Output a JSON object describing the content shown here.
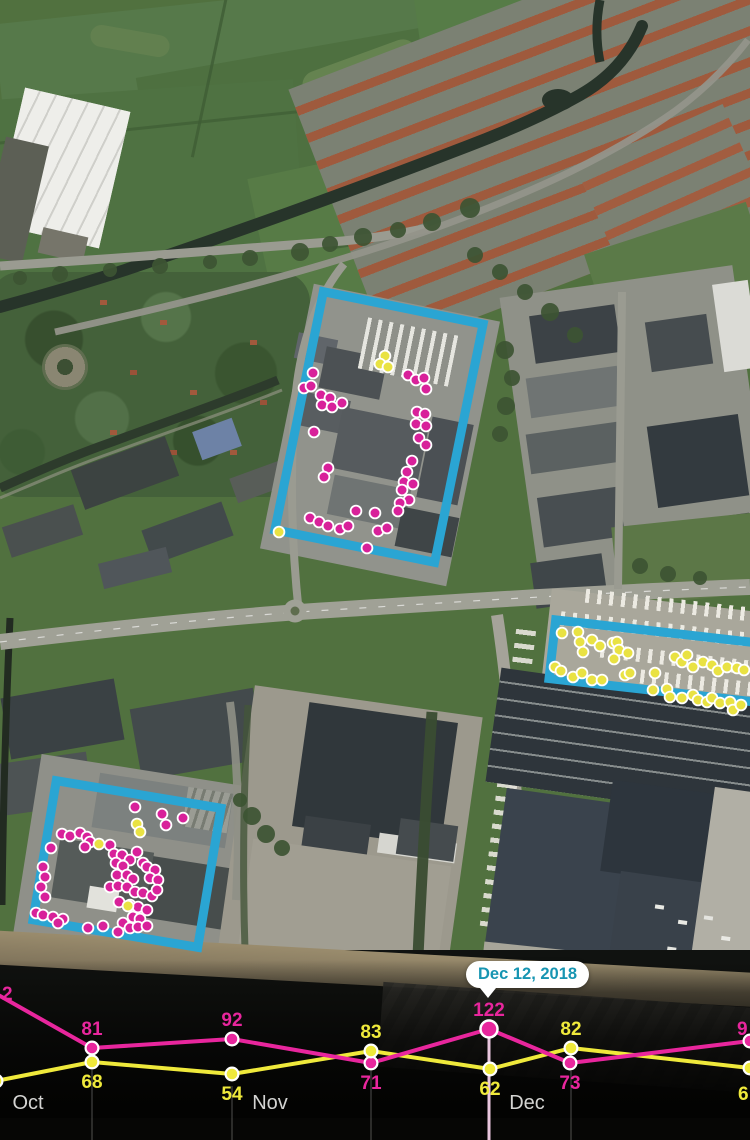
{
  "overlay_colors": {
    "magenta": "#d8219a",
    "yellow": "#e9e243",
    "cyan": "#2aa5d3",
    "tooltip_text": "#1795b2",
    "month_label": "#d4d4d2",
    "gridline": "rgba(255,255,255,0.3)",
    "highlight_gridline": "#e9c6de"
  },
  "map": {
    "regions": [
      {
        "name": "north-site",
        "cx": 379,
        "cy": 427,
        "w": 172,
        "h": 252,
        "angle": 11.5
      },
      {
        "name": "east-site",
        "cx": 682,
        "cy": 664,
        "w": 270,
        "h": 68,
        "angle": 6.5
      },
      {
        "name": "south-site",
        "cx": 127,
        "cy": 864,
        "w": 176,
        "h": 150,
        "angle": 9.5
      }
    ],
    "magenta_dots": [
      [
        313,
        373
      ],
      [
        304,
        388
      ],
      [
        311,
        386
      ],
      [
        321,
        395
      ],
      [
        330,
        398
      ],
      [
        322,
        405
      ],
      [
        332,
        407
      ],
      [
        342,
        403
      ],
      [
        408,
        375
      ],
      [
        416,
        380
      ],
      [
        424,
        378
      ],
      [
        426,
        389
      ],
      [
        417,
        412
      ],
      [
        425,
        414
      ],
      [
        416,
        424
      ],
      [
        426,
        426
      ],
      [
        419,
        438
      ],
      [
        426,
        445
      ],
      [
        412,
        461
      ],
      [
        407,
        472
      ],
      [
        404,
        482
      ],
      [
        413,
        484
      ],
      [
        402,
        490
      ],
      [
        409,
        500
      ],
      [
        400,
        503
      ],
      [
        398,
        511
      ],
      [
        314,
        432
      ],
      [
        328,
        468
      ],
      [
        324,
        477
      ],
      [
        356,
        511
      ],
      [
        375,
        513
      ],
      [
        310,
        518
      ],
      [
        319,
        522
      ],
      [
        328,
        526
      ],
      [
        340,
        529
      ],
      [
        348,
        526
      ],
      [
        378,
        531
      ],
      [
        387,
        528
      ],
      [
        367,
        548
      ],
      [
        135,
        807
      ],
      [
        162,
        814
      ],
      [
        183,
        818
      ],
      [
        166,
        825
      ],
      [
        62,
        834
      ],
      [
        70,
        836
      ],
      [
        80,
        833
      ],
      [
        87,
        837
      ],
      [
        90,
        842
      ],
      [
        85,
        847
      ],
      [
        51,
        848
      ],
      [
        110,
        845
      ],
      [
        114,
        854
      ],
      [
        122,
        855
      ],
      [
        137,
        852
      ],
      [
        130,
        860
      ],
      [
        116,
        863
      ],
      [
        123,
        866
      ],
      [
        43,
        867
      ],
      [
        45,
        877
      ],
      [
        117,
        875
      ],
      [
        127,
        875
      ],
      [
        133,
        879
      ],
      [
        143,
        863
      ],
      [
        147,
        867
      ],
      [
        155,
        870
      ],
      [
        150,
        878
      ],
      [
        158,
        880
      ],
      [
        110,
        887
      ],
      [
        118,
        886
      ],
      [
        127,
        887
      ],
      [
        41,
        887
      ],
      [
        135,
        892
      ],
      [
        143,
        893
      ],
      [
        152,
        896
      ],
      [
        157,
        890
      ],
      [
        45,
        897
      ],
      [
        36,
        913
      ],
      [
        43,
        915
      ],
      [
        53,
        917
      ],
      [
        63,
        919
      ],
      [
        58,
        923
      ],
      [
        119,
        902
      ],
      [
        130,
        905
      ],
      [
        138,
        907
      ],
      [
        147,
        910
      ],
      [
        133,
        917
      ],
      [
        140,
        919
      ],
      [
        123,
        923
      ],
      [
        130,
        928
      ],
      [
        138,
        927
      ],
      [
        118,
        932
      ],
      [
        88,
        928
      ],
      [
        103,
        926
      ],
      [
        147,
        926
      ]
    ],
    "yellow_dots": [
      [
        385,
        356
      ],
      [
        380,
        364
      ],
      [
        388,
        367
      ],
      [
        279,
        532
      ],
      [
        137,
        824
      ],
      [
        140,
        832
      ],
      [
        99,
        844
      ],
      [
        128,
        906
      ],
      [
        562,
        633
      ],
      [
        578,
        632
      ],
      [
        580,
        642
      ],
      [
        592,
        640
      ],
      [
        600,
        646
      ],
      [
        583,
        652
      ],
      [
        613,
        643
      ],
      [
        617,
        642
      ],
      [
        619,
        650
      ],
      [
        614,
        659
      ],
      [
        628,
        653
      ],
      [
        555,
        667
      ],
      [
        561,
        671
      ],
      [
        573,
        677
      ],
      [
        582,
        673
      ],
      [
        592,
        680
      ],
      [
        602,
        680
      ],
      [
        625,
        675
      ],
      [
        630,
        673
      ],
      [
        655,
        673
      ],
      [
        675,
        657
      ],
      [
        682,
        662
      ],
      [
        687,
        655
      ],
      [
        693,
        667
      ],
      [
        703,
        662
      ],
      [
        712,
        665
      ],
      [
        718,
        671
      ],
      [
        727,
        667
      ],
      [
        737,
        668
      ],
      [
        744,
        670
      ],
      [
        653,
        690
      ],
      [
        667,
        689
      ],
      [
        670,
        697
      ],
      [
        682,
        698
      ],
      [
        693,
        695
      ],
      [
        698,
        700
      ],
      [
        707,
        702
      ],
      [
        712,
        698
      ],
      [
        720,
        703
      ],
      [
        730,
        702
      ],
      [
        733,
        710
      ],
      [
        741,
        705
      ]
    ]
  },
  "chart_data": {
    "type": "line",
    "x_axis_months": [
      {
        "label": "Oct",
        "x": 28,
        "y": 1109
      },
      {
        "label": "Nov",
        "x": 270,
        "y": 1109
      },
      {
        "label": "Dec",
        "x": 527,
        "y": 1109
      }
    ],
    "highlight": {
      "date_label": "Dec 12, 2018",
      "series": "magenta",
      "value": 122
    },
    "series": [
      {
        "name": "magenta",
        "color": "#e8269d",
        "points": [
          {
            "x": -14,
            "y": 988,
            "label": "2",
            "label_x": 2,
            "label_y": 1000,
            "anchor": "start"
          },
          {
            "x": 92,
            "y": 1048,
            "label": "81",
            "label_y": 1035
          },
          {
            "x": 232,
            "y": 1039,
            "label": "92",
            "label_y": 1026
          },
          {
            "x": 371,
            "y": 1063,
            "label": "71",
            "label_y": 1089
          },
          {
            "x": 489,
            "y": 1029,
            "label": "122",
            "label_y": 1016,
            "highlight": true
          },
          {
            "x": 570,
            "y": 1063,
            "label": "73",
            "label_y": 1089
          },
          {
            "x": 750,
            "y": 1041,
            "label": "9",
            "label_x": 737,
            "label_y": 1035,
            "anchor": "start"
          }
        ]
      },
      {
        "name": "yellow",
        "color": "#efe93b",
        "points": [
          {
            "x": -4,
            "y": 1081
          },
          {
            "x": 92,
            "y": 1062,
            "label": "68",
            "label_y": 1088
          },
          {
            "x": 232,
            "y": 1074,
            "label": "54",
            "label_y": 1100
          },
          {
            "x": 371,
            "y": 1051,
            "label": "83",
            "label_y": 1038
          },
          {
            "x": 490,
            "y": 1069,
            "label": "62",
            "label_y": 1095
          },
          {
            "x": 571,
            "y": 1048,
            "label": "82",
            "label_y": 1035
          },
          {
            "x": 750,
            "y": 1068,
            "label": "6",
            "label_x": 738,
            "label_y": 1100,
            "anchor": "start"
          }
        ]
      }
    ],
    "gridlines": [
      {
        "x": 92,
        "y1": 1070,
        "y2": 1140
      },
      {
        "x": 232,
        "y1": 1086,
        "y2": 1140
      },
      {
        "x": 371,
        "y1": 1071,
        "y2": 1140
      },
      {
        "x": 571,
        "y1": 1071,
        "y2": 1140
      }
    ],
    "highlight_line": {
      "x": 489,
      "y1": 1029,
      "y2": 1140
    }
  },
  "tooltip": {
    "text": "Dec 12, 2018",
    "left": 466,
    "top": 961
  }
}
